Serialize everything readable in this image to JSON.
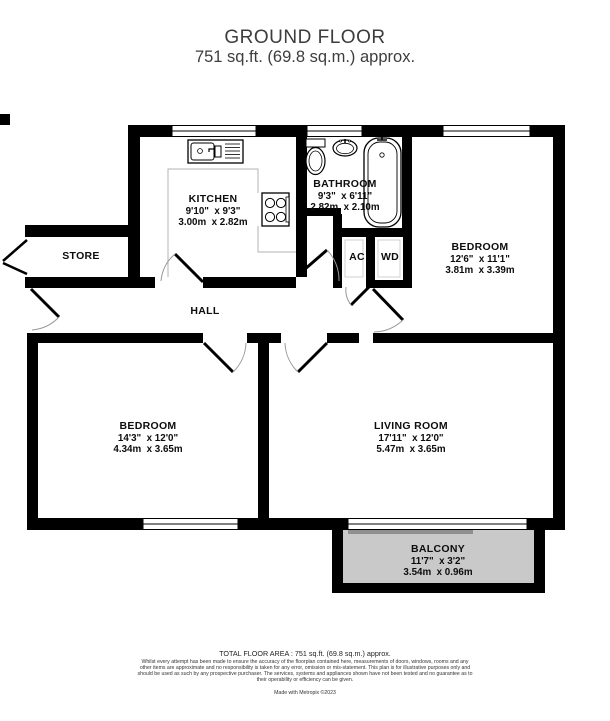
{
  "header": {
    "title": "GROUND FLOOR",
    "subtitle": "751 sq.ft. (69.8 sq.m.) approx."
  },
  "rooms": {
    "kitchen": {
      "name": "KITCHEN",
      "imperial": "9'10\"  x 9'3\"",
      "metric": "3.00m  x 2.82m"
    },
    "bathroom": {
      "name": "BATHROOM",
      "imperial": "9'3\"  x 6'11\"",
      "metric": "2.82m  x 2.10m"
    },
    "bedroom1": {
      "name": "BEDROOM",
      "imperial": "12'6\"  x 11'1\"",
      "metric": "3.81m  x 3.39m"
    },
    "bedroom2": {
      "name": "BEDROOM",
      "imperial": "14'3\"  x 12'0\"",
      "metric": "4.34m  x 3.65m"
    },
    "living": {
      "name": "LIVING ROOM",
      "imperial": "17'11\"  x 12'0\"",
      "metric": "5.47m  x 3.65m"
    },
    "balcony": {
      "name": "BALCONY",
      "imperial": "11'7\"  x 3'2\"",
      "metric": "3.54m  x 0.96m"
    },
    "store": {
      "name": "STORE"
    },
    "hall": {
      "name": "HALL"
    },
    "ac": {
      "name": "AC"
    },
    "wd": {
      "name": "WD"
    }
  },
  "footer": {
    "total_area": "TOTAL FLOOR AREA : 751 sq.ft. (69.8 sq.m.) approx.",
    "disclaimer": "Whilst every attempt has been made to ensure the accuracy of the floorplan contained here, measurements of doors, windows, rooms and any other items are approximate and no responsibility is taken for any error, omission or mis-statement. This plan is for illustrative purposes only and should be used as such by any prospective purchaser. The services, systems and appliances shown have not been tested and no guarantee as to their operability or efficiency can be given.",
    "credit": "Made with Metropix ©2023"
  },
  "colors": {
    "wall": "#000000",
    "balcony_fill": "#c9c9c9",
    "counter_line": "#b3b3b3",
    "door_arc": "#999999"
  }
}
